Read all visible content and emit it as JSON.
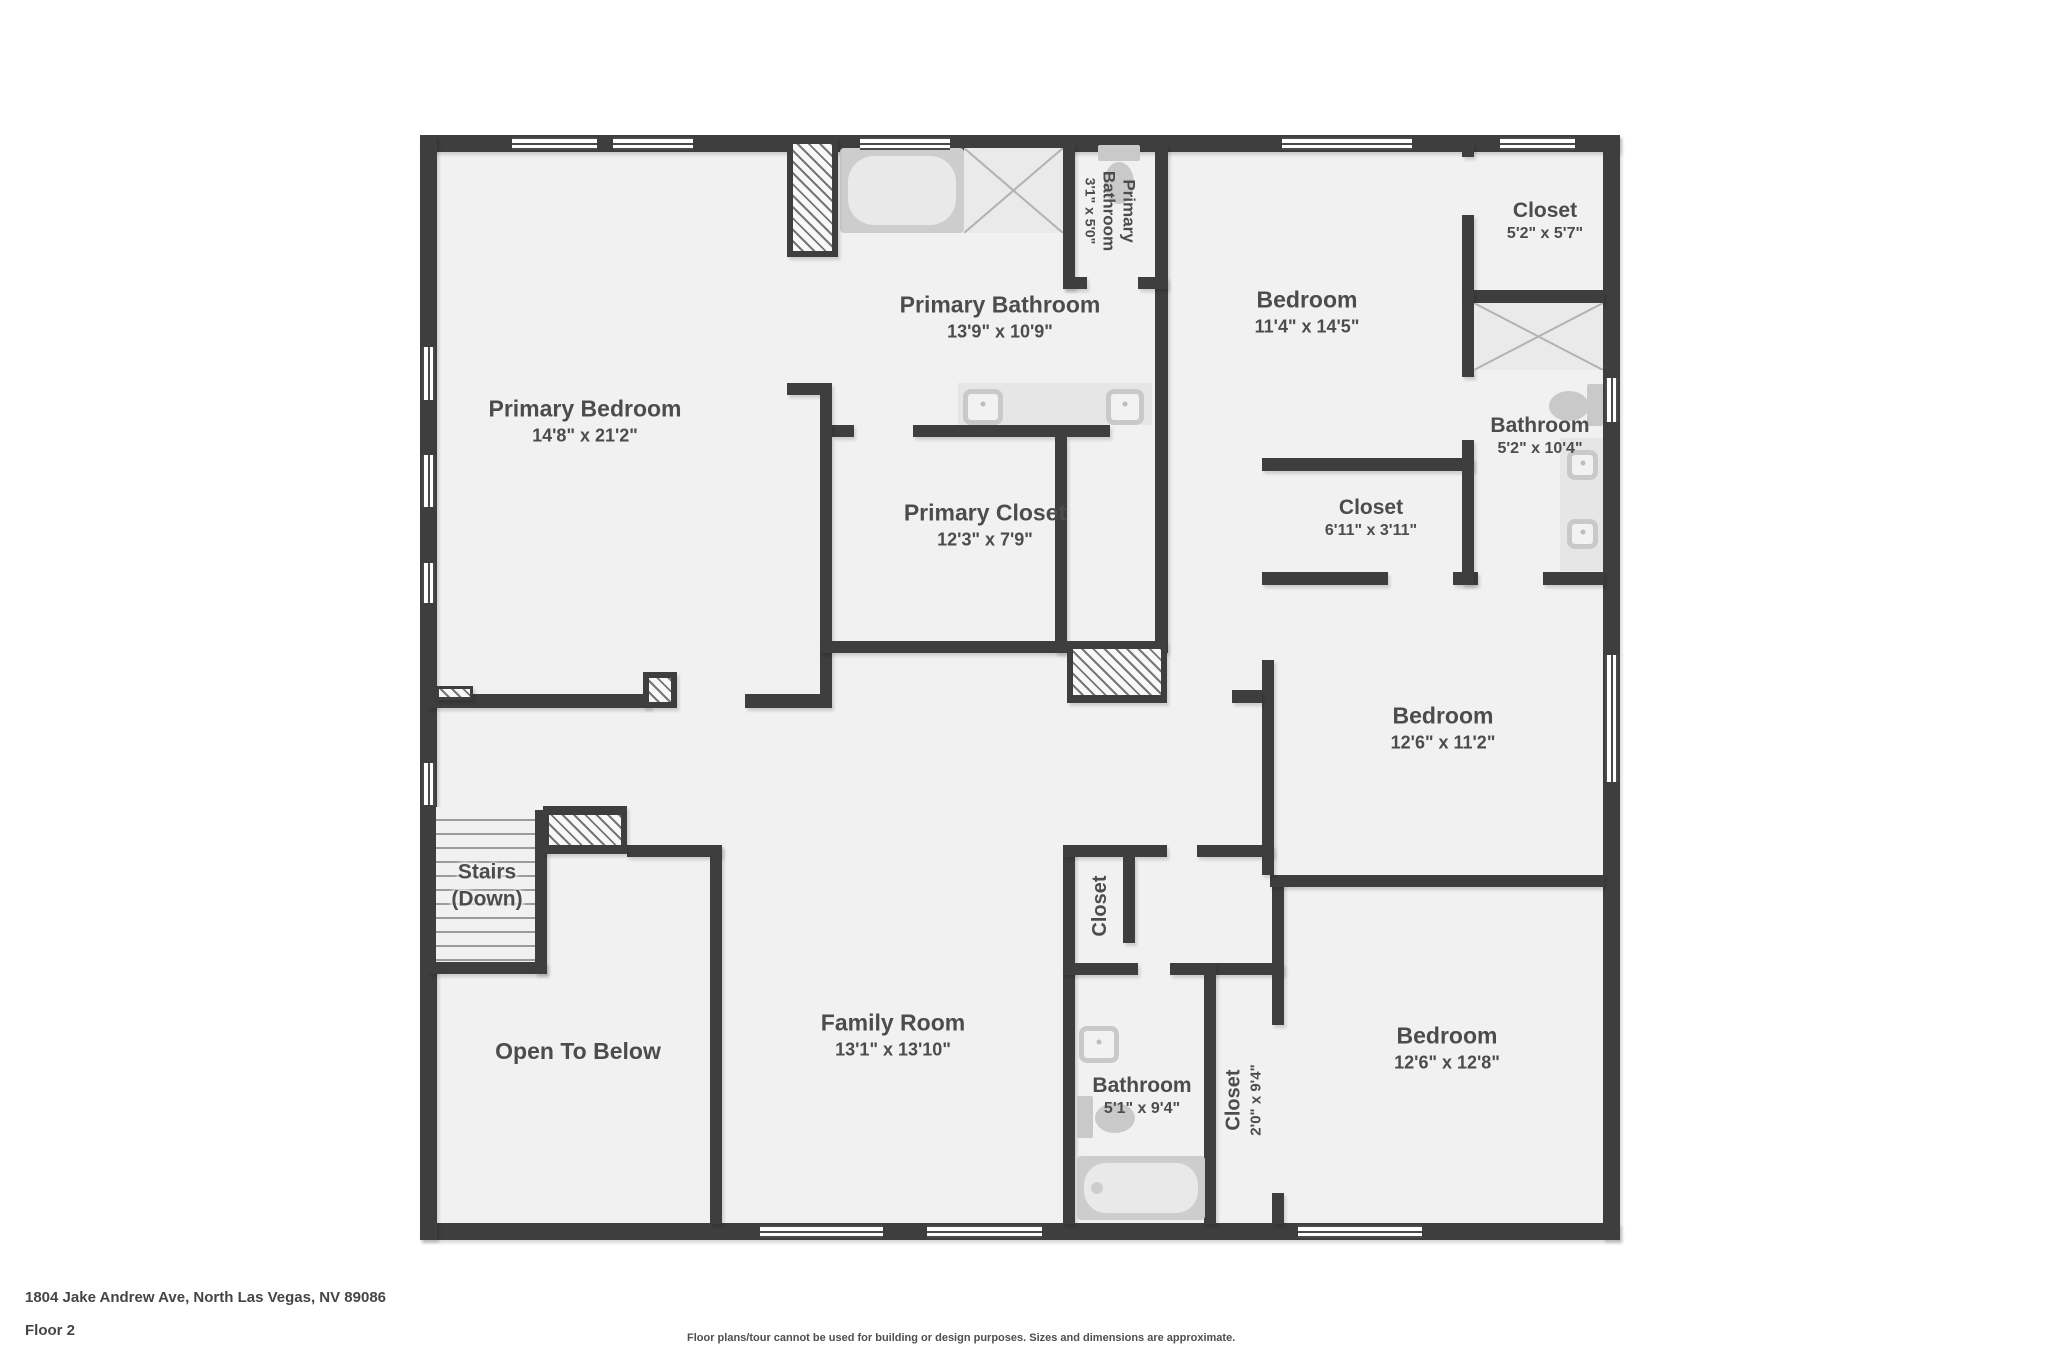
{
  "footer": {
    "address": "1804 Jake Andrew Ave, North Las Vegas, NV 89086",
    "floor_label": "Floor 2",
    "disclaimer": "Floor plans/tour cannot be used for building or design purposes. Sizes and dimensions are approximate."
  },
  "colors": {
    "wall": "#3e3e3e",
    "floor": "#f1f1f1",
    "label_text": "#4c4c4c",
    "fixture": "#c9c9c9",
    "background": "#ffffff"
  },
  "fixture_types": [
    "bathtub",
    "shower",
    "toilet",
    "sink",
    "vanity",
    "window",
    "stairs",
    "hatched-wall"
  ],
  "rooms": [
    {
      "id": "primary-bedroom",
      "name": "Primary Bedroom",
      "dims": "14'8\" x 21'2\""
    },
    {
      "id": "primary-bathroom",
      "name": "Primary Bathroom",
      "dims": "13'9\" x 10'9\""
    },
    {
      "id": "primary-water-closet",
      "name": "Primary Bathroom",
      "dims": "3'1\" x 5'0\"",
      "orientation": "vertical"
    },
    {
      "id": "closet-upper-right",
      "name": "Closet",
      "dims": "5'2\" x 5'7\""
    },
    {
      "id": "bedroom-top-right",
      "name": "Bedroom",
      "dims": "11'4\" x 14'5\""
    },
    {
      "id": "bathroom-ensuite",
      "name": "Bathroom",
      "dims": "5'2\" x 10'4\""
    },
    {
      "id": "closet-bedroom-mid",
      "name": "Closet",
      "dims": "6'11\" x 3'11\""
    },
    {
      "id": "primary-closet",
      "name": "Primary Closet",
      "dims": "12'3\" x 7'9\""
    },
    {
      "id": "bedroom-middle-right",
      "name": "Bedroom",
      "dims": "12'6\" x 11'2\""
    },
    {
      "id": "stairs",
      "name": "Stairs",
      "sub": "(Down)"
    },
    {
      "id": "open-to-below",
      "name": "Open To Below"
    },
    {
      "id": "family-room",
      "name": "Family Room",
      "dims": "13'1\" x 13'10\""
    },
    {
      "id": "hall-closet",
      "name": "Closet",
      "orientation": "vertical"
    },
    {
      "id": "bathroom-hall",
      "name": "Bathroom",
      "dims": "5'1\" x 9'4\""
    },
    {
      "id": "closet-bedroom-bottom",
      "name": "Closet",
      "dims": "2'0\" x 9'4\"",
      "orientation": "vertical"
    },
    {
      "id": "bedroom-bottom-right",
      "name": "Bedroom",
      "dims": "12'6\" x 12'8\""
    }
  ]
}
